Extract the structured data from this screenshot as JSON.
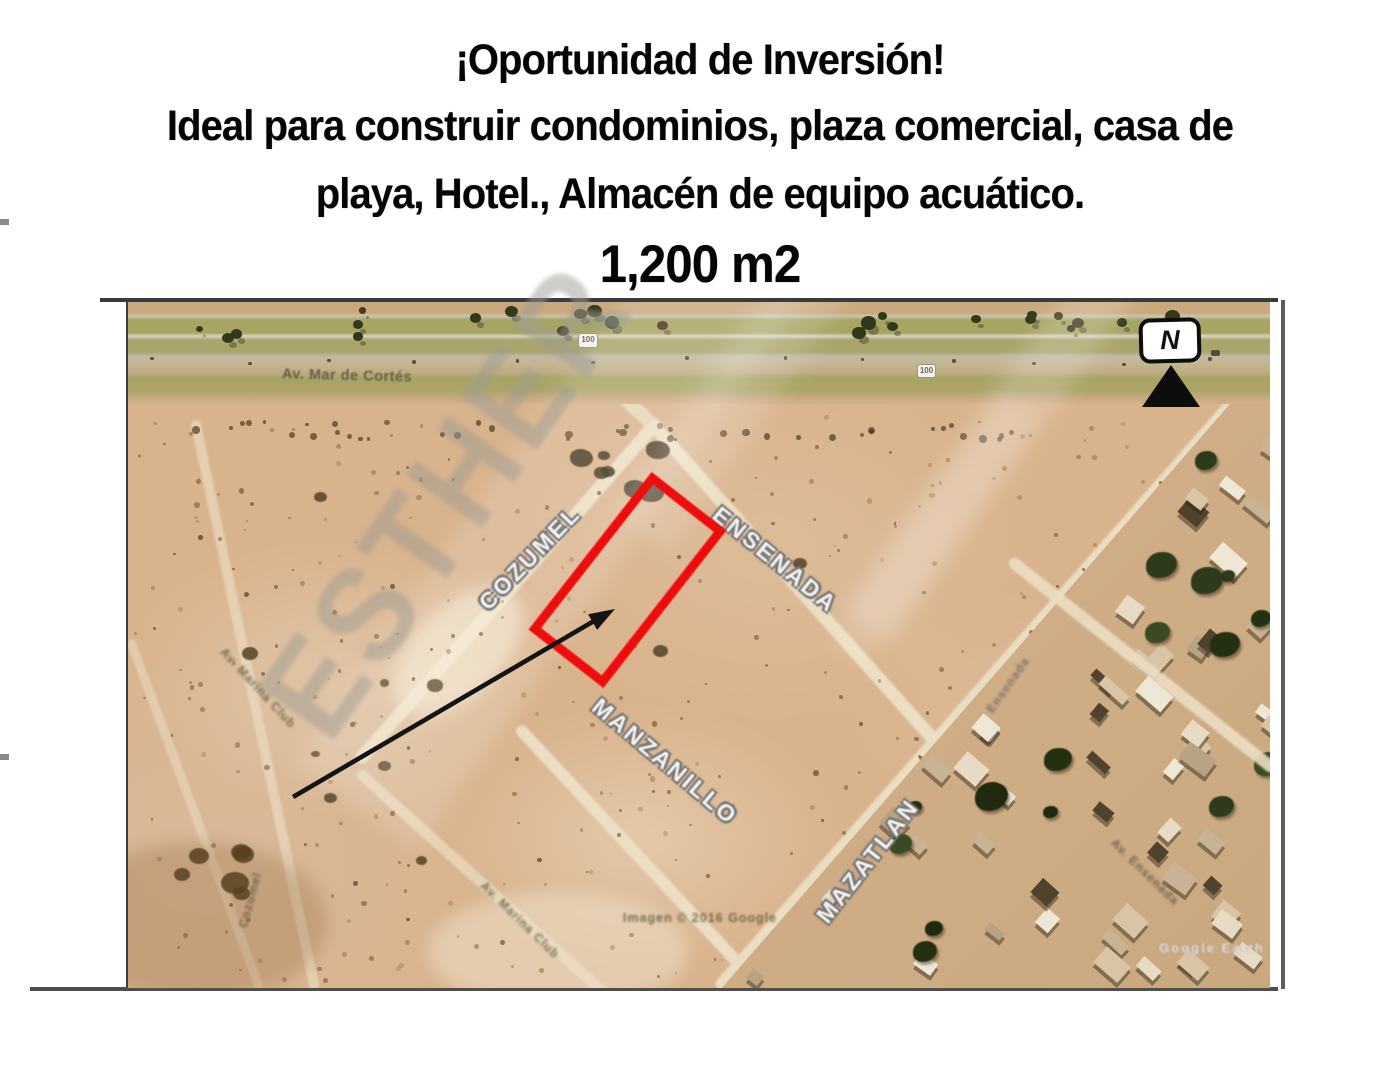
{
  "header": {
    "line1": "¡Oportunidad de Inversión!",
    "line2": "Ideal para construir condominios, plaza comercial, casa de",
    "line3": "playa, Hotel., Almacén de equipo acuático.",
    "line4": "1,200 m2"
  },
  "map": {
    "compass_label": "N",
    "watermark_text": "ESTHER",
    "route_shield": "100",
    "highway_label": "Av. Mar de Cortés",
    "streets": {
      "cozumel": "COZUMEL",
      "ensenada": "ENSENADA",
      "manzanillo": "MANZANILLO",
      "mazatlan": "MAZATLAN"
    },
    "minor_streets": {
      "left": "Av. Marina Club",
      "bottom": "Av. Marina Club",
      "left_low": "Cozumel",
      "right_mid": "Ensenada",
      "bottom_right": "Av. Ensenada"
    },
    "attribution": "Imagen © 2016 Google",
    "corner_text": "Google Earth",
    "parcel_outline_color": "#ee0d0d",
    "arrow_color": "#141414"
  }
}
